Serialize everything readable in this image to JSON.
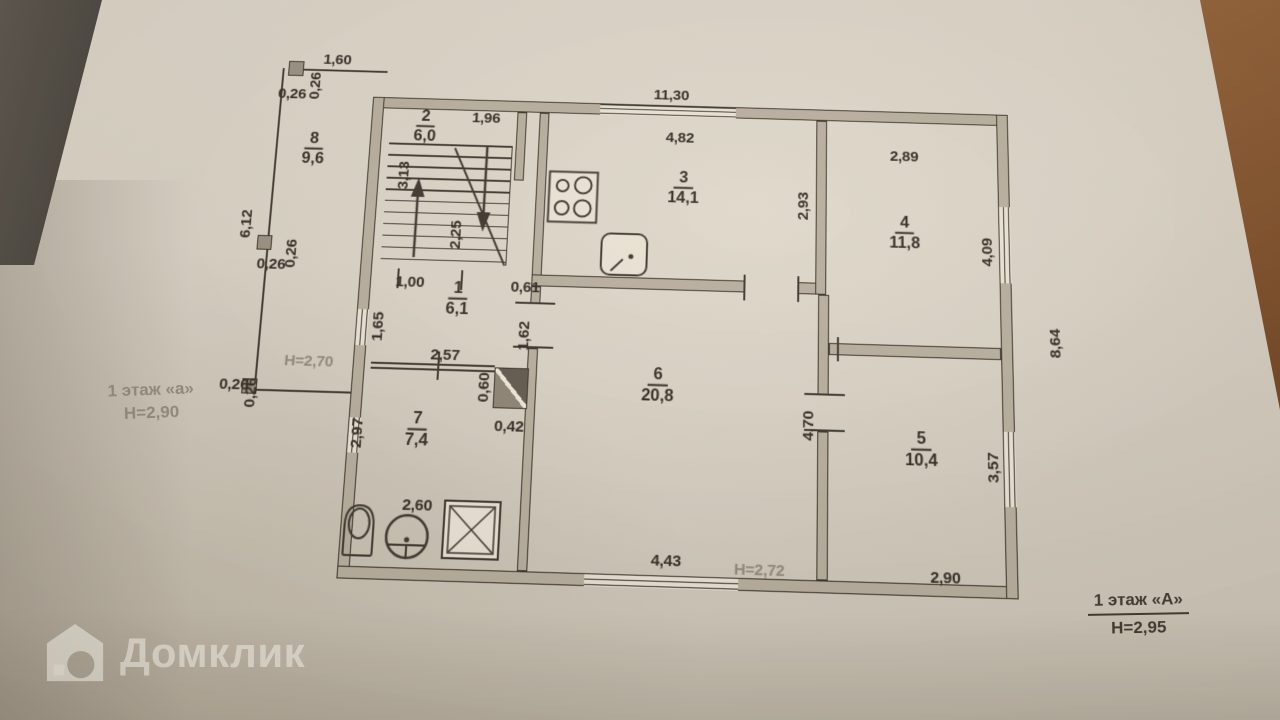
{
  "watermark": {
    "brand": "Домклик"
  },
  "plan": {
    "rooms": {
      "r1": {
        "number": "1",
        "area": "6,1"
      },
      "r2": {
        "number": "2",
        "area": "6,0"
      },
      "r3": {
        "number": "3",
        "area": "14,1"
      },
      "r4": {
        "number": "4",
        "area": "11,8"
      },
      "r5": {
        "number": "5",
        "area": "10,4"
      },
      "r6": {
        "number": "6",
        "area": "20,8"
      },
      "r7": {
        "number": "7",
        "area": "7,4"
      },
      "r8": {
        "number": "8",
        "area": "9,6"
      }
    },
    "heights": {
      "annex_note": "Н=2,70",
      "room6_note": "Н=2,72"
    },
    "floor_labels": {
      "annex": {
        "title": "1 этаж «а»",
        "height": "Н=2,90"
      },
      "main": {
        "title": "1 этаж «А»",
        "height": "Н=2,95"
      }
    },
    "dimensions": {
      "veranda_top": "1,60",
      "veranda_col_top_a": "0,26",
      "veranda_col_top_b": "0,26",
      "veranda_left": "6,12",
      "veranda_col_mid_a": "0,26",
      "veranda_col_mid_b": "0,26",
      "veranda_col_bot_a": "0,26",
      "veranda_col_bot_b": "0,26",
      "top_window": "11,30",
      "kitchen_width": "4,82",
      "room2_width": "1,96",
      "stairs_length": "3,13",
      "stairs_run": "2,25",
      "stairs_bottom": "1,00",
      "stairs_gap": "0,61",
      "kitchen_wall": "2,93",
      "room4_width": "2,89",
      "room4_window": "4,09",
      "right_wall": "8,64",
      "hall_window": "1,65",
      "hall_door": "1,62",
      "hall_width": "2,57",
      "duct_width": "0,60",
      "duct_height": "0,42",
      "bath_left": "2,97",
      "bath_width": "2,60",
      "room6_width": "4,43",
      "room6_wall": "4,70",
      "room5_window": "3,57",
      "room5_width": "2,90"
    }
  }
}
